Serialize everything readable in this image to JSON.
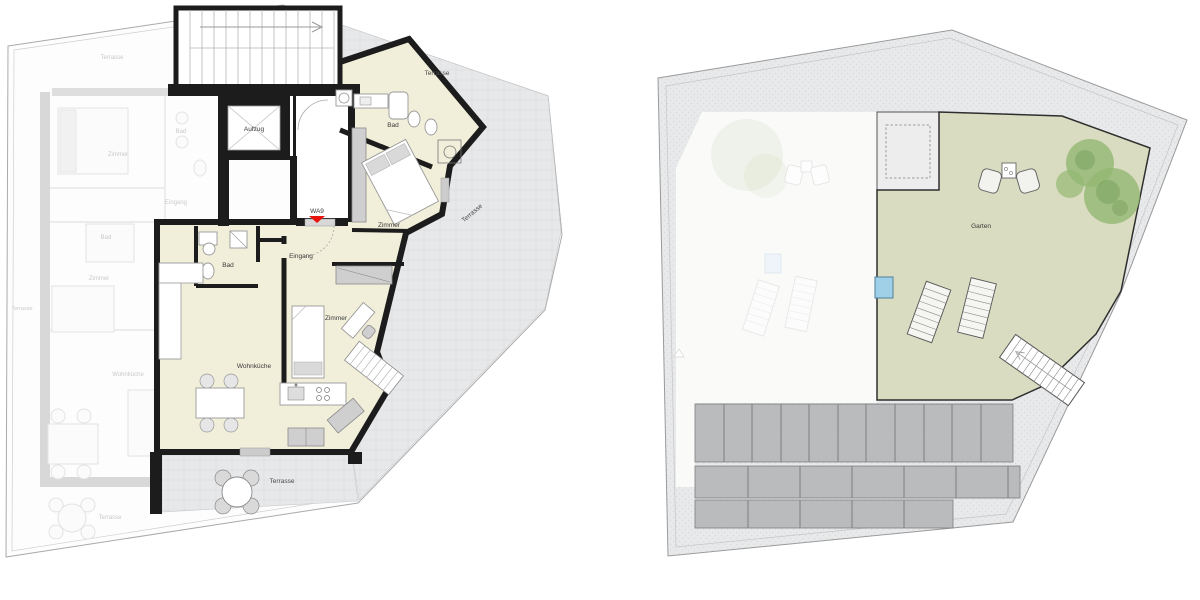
{
  "sheet": {
    "description": "Architectural drawing sheet with two floor plans",
    "left_plan_title": "apartment-floor-plan",
    "right_plan_title": "roof-garden-plan"
  },
  "left": {
    "unit": {
      "label": "WA9",
      "marker_color": "#e8140c"
    },
    "rooms": {
      "aufzug": "Aufzug",
      "bad_top": "Bad",
      "zimmer_top": "Zimmer",
      "eingang": "Eingang",
      "bad_small": "Bad",
      "zimmer_small": "Zimmer",
      "wohnkueche": "Wohnküche",
      "terrasse_top": "Terrasse",
      "terrasse_right": "Terrasse",
      "terrasse_bottom": "Terrasse"
    },
    "ghost": {
      "terrasse_top": "Terrasse",
      "zimmer_top": "Zimmer",
      "bad_top": "Bad",
      "eingang": "Eingang",
      "bad_mid": "Bad",
      "zimmer_mid": "Zimmer",
      "terrasse_left": "Terrasse",
      "wohnkueche": "Wohnküche",
      "terrasse_bottom": "Terrasse"
    }
  },
  "right": {
    "labels": {
      "garten": "Garten"
    }
  },
  "colors": {
    "active_room_fill": "#f1eed9",
    "garden_fill": "#d9dcc0",
    "terrace_fill": "#e7e8ea",
    "band_fill": "#e8e9ea",
    "wall": "#1c1c1c",
    "panel_fill": "#babbbd",
    "pool_fill": "#9fd0e8",
    "tree_fill": "#94b873",
    "marker_red": "#e8140c"
  }
}
